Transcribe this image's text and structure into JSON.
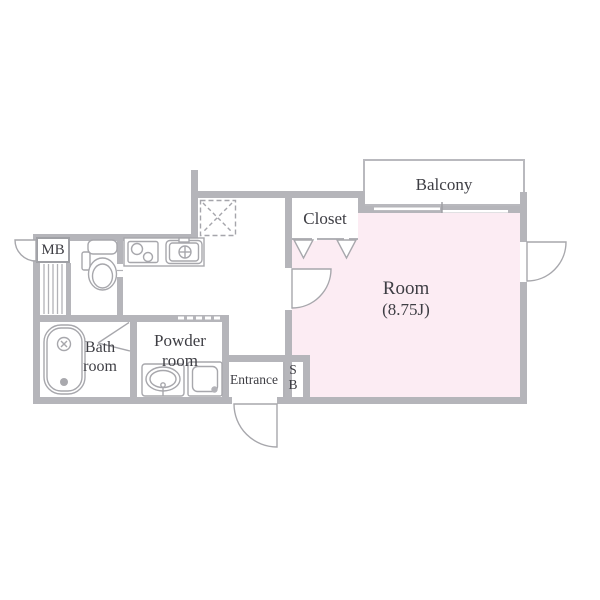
{
  "floor_plan": {
    "type": "apartment-floor-plan",
    "colors": {
      "room_fill": "#fcecf3",
      "wall": "#b5b5ba",
      "fixture_line": "#a7a7ac",
      "text": "#3e3e44"
    },
    "labels": {
      "balcony": "Balcony",
      "closet": "Closet",
      "room_name": "Room",
      "room_size": "(8.75J)",
      "meter_box": "MB",
      "bath_line1": "Bath",
      "bath_line2": "room",
      "powder_line1": "Powder",
      "powder_line2": "room",
      "entrance": "Entrance",
      "shoe_box_line1": "S",
      "shoe_box_line2": "B"
    }
  }
}
